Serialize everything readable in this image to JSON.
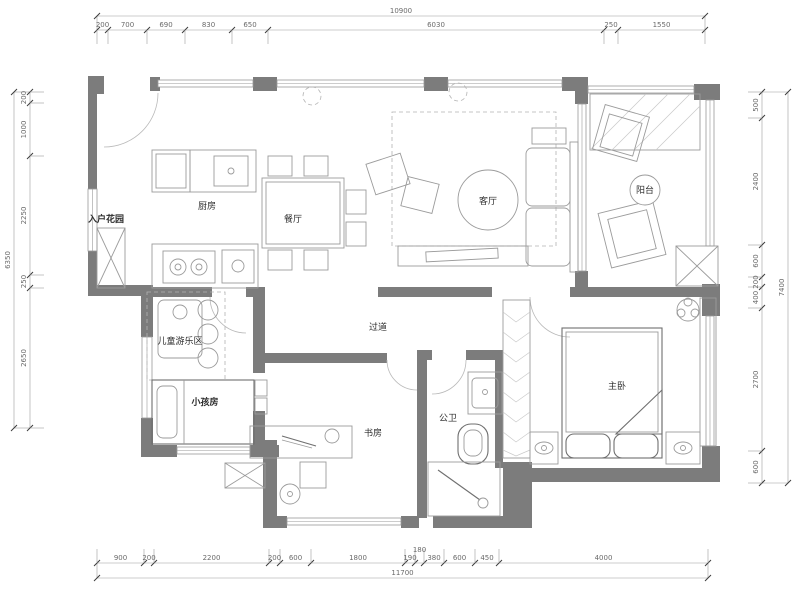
{
  "title": "apartment-floor-plan",
  "colors": {
    "wall": "#7c7c7c",
    "furniture": "#9b9b9b",
    "dimension_text": "#6a6a6a",
    "label_text": "#2d2d2d",
    "background": "#ffffff"
  },
  "rooms": [
    {
      "name": "entry-garden",
      "label": "入户花园",
      "x": 106,
      "y": 222,
      "size": 9,
      "bold": true
    },
    {
      "name": "kitchen",
      "label": "厨房",
      "x": 207,
      "y": 209,
      "size": 9,
      "bold": false
    },
    {
      "name": "dining-room",
      "label": "餐厅",
      "x": 293,
      "y": 222,
      "size": 9,
      "bold": false
    },
    {
      "name": "living-room",
      "label": "客厅",
      "x": 488,
      "y": 204,
      "size": 9,
      "bold": false
    },
    {
      "name": "balcony",
      "label": "阳台",
      "x": 645,
      "y": 193,
      "size": 8,
      "bold": false
    },
    {
      "name": "kids-play-area",
      "label": "儿童游乐区",
      "x": 180,
      "y": 344,
      "size": 7,
      "bold": false
    },
    {
      "name": "kids-room",
      "label": "小孩房",
      "x": 205,
      "y": 405,
      "size": 9,
      "bold": true
    },
    {
      "name": "hallway",
      "label": "过道",
      "x": 378,
      "y": 330,
      "size": 9,
      "bold": false
    },
    {
      "name": "study",
      "label": "书房",
      "x": 373,
      "y": 436,
      "size": 8,
      "bold": false
    },
    {
      "name": "guest-bath",
      "label": "公卫",
      "x": 448,
      "y": 421,
      "size": 9,
      "bold": false
    },
    {
      "name": "master-bedroom",
      "label": "主卧",
      "x": 617,
      "y": 389,
      "size": 9,
      "bold": false
    }
  ],
  "dimensions": {
    "top": {
      "overall": "10900",
      "segments": [
        "200",
        "700",
        "690",
        "830",
        "650",
        "6030",
        "250",
        "1550"
      ],
      "ticks": [
        97,
        108,
        147,
        185,
        232,
        268,
        604,
        618,
        705
      ],
      "chain": 30,
      "overall_line": 16
    },
    "bottom": {
      "overall": "11700",
      "segments": [
        "900",
        "200",
        "2200",
        "200",
        "600",
        "1800",
        "190",
        "180",
        "380",
        "600",
        "450",
        "4000"
      ],
      "ticks": [
        97,
        144,
        154,
        269,
        280,
        311,
        405,
        415,
        424,
        444,
        475,
        499,
        708
      ],
      "chain": 563,
      "overall_line": 578
    },
    "left": {
      "overall": "6350",
      "segments": [
        "200",
        "1000",
        "2250",
        "250",
        "2650"
      ],
      "ticks": [
        92,
        103,
        156,
        275,
        288,
        428
      ],
      "chain": 30,
      "overall_line": 14
    },
    "right": {
      "overall": "7400",
      "segments": [
        "500",
        "2400",
        "600",
        "200",
        "400",
        "2700",
        "600"
      ],
      "ticks": [
        92,
        118,
        245,
        277,
        287,
        308,
        451,
        483
      ],
      "chain": 762,
      "overall_line": 788
    }
  }
}
